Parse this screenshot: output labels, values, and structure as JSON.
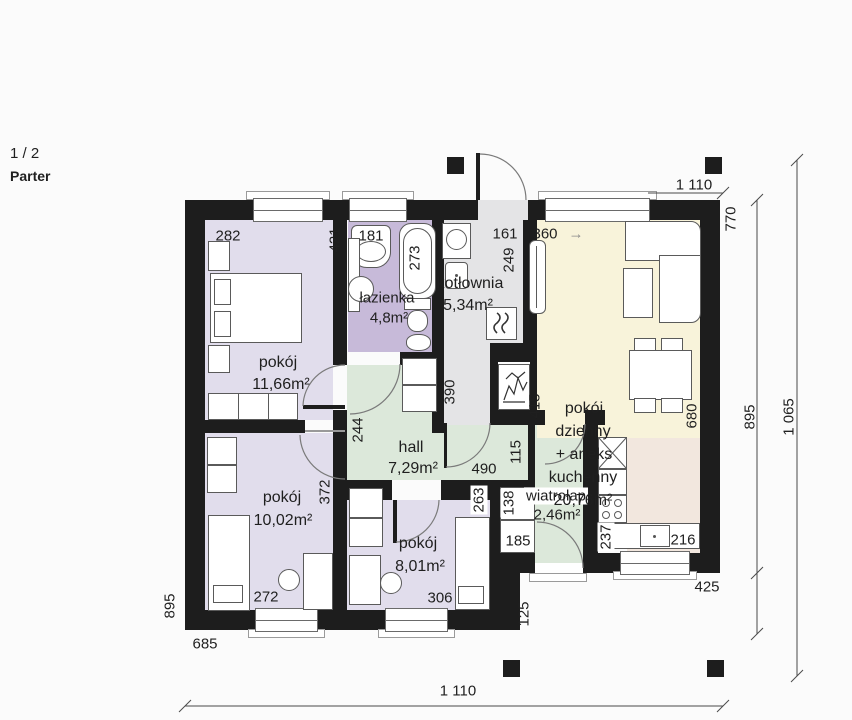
{
  "header": {
    "page": "1 / 2",
    "floor": "Parter"
  },
  "rooms": {
    "bedroom1": {
      "name": "pokój",
      "area": "11,66m²"
    },
    "bedroom2": {
      "name": "pokój",
      "area": "10,02m²"
    },
    "bedroom3": {
      "name": "pokój",
      "area": "8,01m²"
    },
    "bathroom": {
      "name": "łazienka",
      "area": "4,8m²"
    },
    "boiler_room": {
      "name": "kotłownia",
      "area": "5,34m²"
    },
    "hall": {
      "name": "hall",
      "area": "7,29m²"
    },
    "vestibule": {
      "name": "wiatrołap",
      "area": "2,46m²"
    },
    "living": {
      "line1": "pokój",
      "line2": "dzienny",
      "line3": "+ aneks",
      "line4": "kuchenny",
      "area": "20,76m²"
    }
  },
  "dims": {
    "w282": "282",
    "h421": "421",
    "basin181": "181",
    "tub273": "273",
    "kot161": "161",
    "kot249": "249",
    "cor390": "390",
    "liv360": "360",
    "liv415": "415",
    "liv680": "680",
    "hall244": "244",
    "hall490": "490",
    "pass115": "115",
    "r2_372": "372",
    "r2_272": "272",
    "r3_263": "263",
    "r3_306": "306",
    "clo138": "138",
    "clo185": "185",
    "kit237": "237",
    "kit216": "216",
    "out425": "425",
    "out125": "125",
    "left895": "895",
    "bottom685": "685",
    "top1110": "1 110",
    "bottom1110": "1 110",
    "right770": "770",
    "right895": "895",
    "right1065": "1 065"
  },
  "icons": {
    "arrow": "→"
  },
  "colors": {
    "wall": "#1d1d1d",
    "bedroom": "#e1ddec",
    "bathroom": "#c7bad9",
    "hall": "#dce8da",
    "boiler": "#e4e4e6",
    "living": "#f8f3da",
    "kitchen": "#f2e7de",
    "background": "#fbfbfb"
  }
}
